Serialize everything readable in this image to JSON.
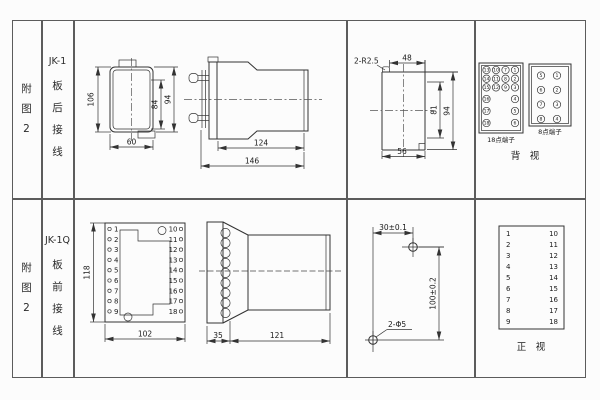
{
  "figure": {
    "r1": {
      "fig_no": [
        "附",
        "图",
        "2"
      ],
      "model": "JK-1",
      "wiring": [
        "板",
        "后",
        "接",
        "线"
      ],
      "rear_view": {
        "height": "106",
        "inner_height": "84",
        "outer_height": "94",
        "width": "60"
      },
      "side_view": {
        "body_depth": "124",
        "total_depth": "146"
      },
      "cutout": {
        "corner_note": "2-R2.5",
        "top_width": "48",
        "inner_height": "81",
        "outer_height": "94",
        "bottom_width": "56"
      },
      "back_view": {
        "label_18": "18点端子",
        "label_8": "8点端子",
        "caption": "背　视",
        "t18": [
          [
            "13",
            "10",
            "7",
            "1"
          ],
          [
            "14",
            "11",
            "8",
            "2"
          ],
          [
            "15",
            "12",
            "9",
            "3"
          ],
          [
            "16",
            "4"
          ],
          [
            "17",
            "5"
          ],
          [
            "18",
            "6"
          ]
        ],
        "t8": [
          [
            "5",
            "1"
          ],
          [
            "6",
            "2"
          ],
          [
            "7",
            "3"
          ],
          [
            "8",
            "4"
          ]
        ]
      }
    },
    "r2": {
      "fig_no": [
        "附",
        "图",
        "2"
      ],
      "model": "JK-1Q",
      "wiring": [
        "板",
        "前",
        "接",
        "线"
      ],
      "front_view": {
        "height": "118",
        "width": "102"
      },
      "terminals": {
        "left": [
          "1",
          "2",
          "3",
          "4",
          "5",
          "6",
          "7",
          "8",
          "9"
        ],
        "right": [
          "10",
          "11",
          "12",
          "13",
          "14",
          "15",
          "16",
          "17",
          "18"
        ]
      },
      "side_view": {
        "plate_depth": "35",
        "body_depth": "121"
      },
      "drill": {
        "hole_spacing_h": "30±0.1",
        "hole_spacing_v": "100±0.2",
        "hole_note": "2-Φ5"
      },
      "front_table": {
        "caption": "正　视"
      }
    }
  }
}
